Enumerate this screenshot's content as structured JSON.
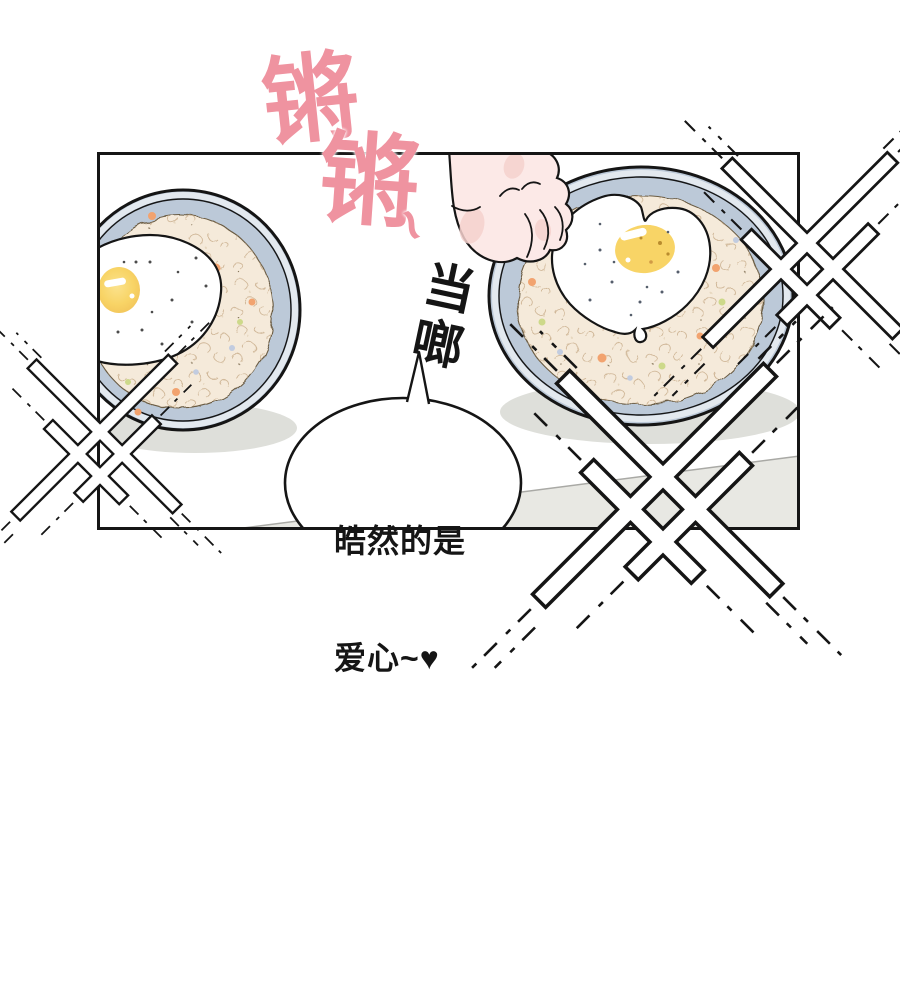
{
  "scene": {
    "kind": "manhua-comic-panel",
    "background": "#FFFFFF"
  },
  "sfx": {
    "clang_first": "锵",
    "clang_second": "锵",
    "tilde": "~",
    "clatter_vertical": "当啷"
  },
  "speech_bubble": {
    "line1": "皓然的是",
    "line2": "爱心~♥"
  },
  "colors": {
    "sfx_pink": "#EF93A0",
    "ink": "#151515",
    "plate_blue": "#BCC9D8",
    "plate_rim_light": "#E3E9EF",
    "rice_beige": "#F5EADA",
    "rice_texture": "#C9AE8C",
    "egg_white": "#FFFFFF",
    "yolk_yellow": "#F8D466",
    "carrot_orange": "#F2A36F",
    "pea_green": "#CDD98A",
    "speck_blue": "#C2CCE0",
    "skin": "#FCE9E7",
    "blush": "#F6D2CE",
    "table_gray": "#E8E8E3",
    "table_edge": "#A9A9A5",
    "shadow_gray": "#DEDFDA"
  }
}
